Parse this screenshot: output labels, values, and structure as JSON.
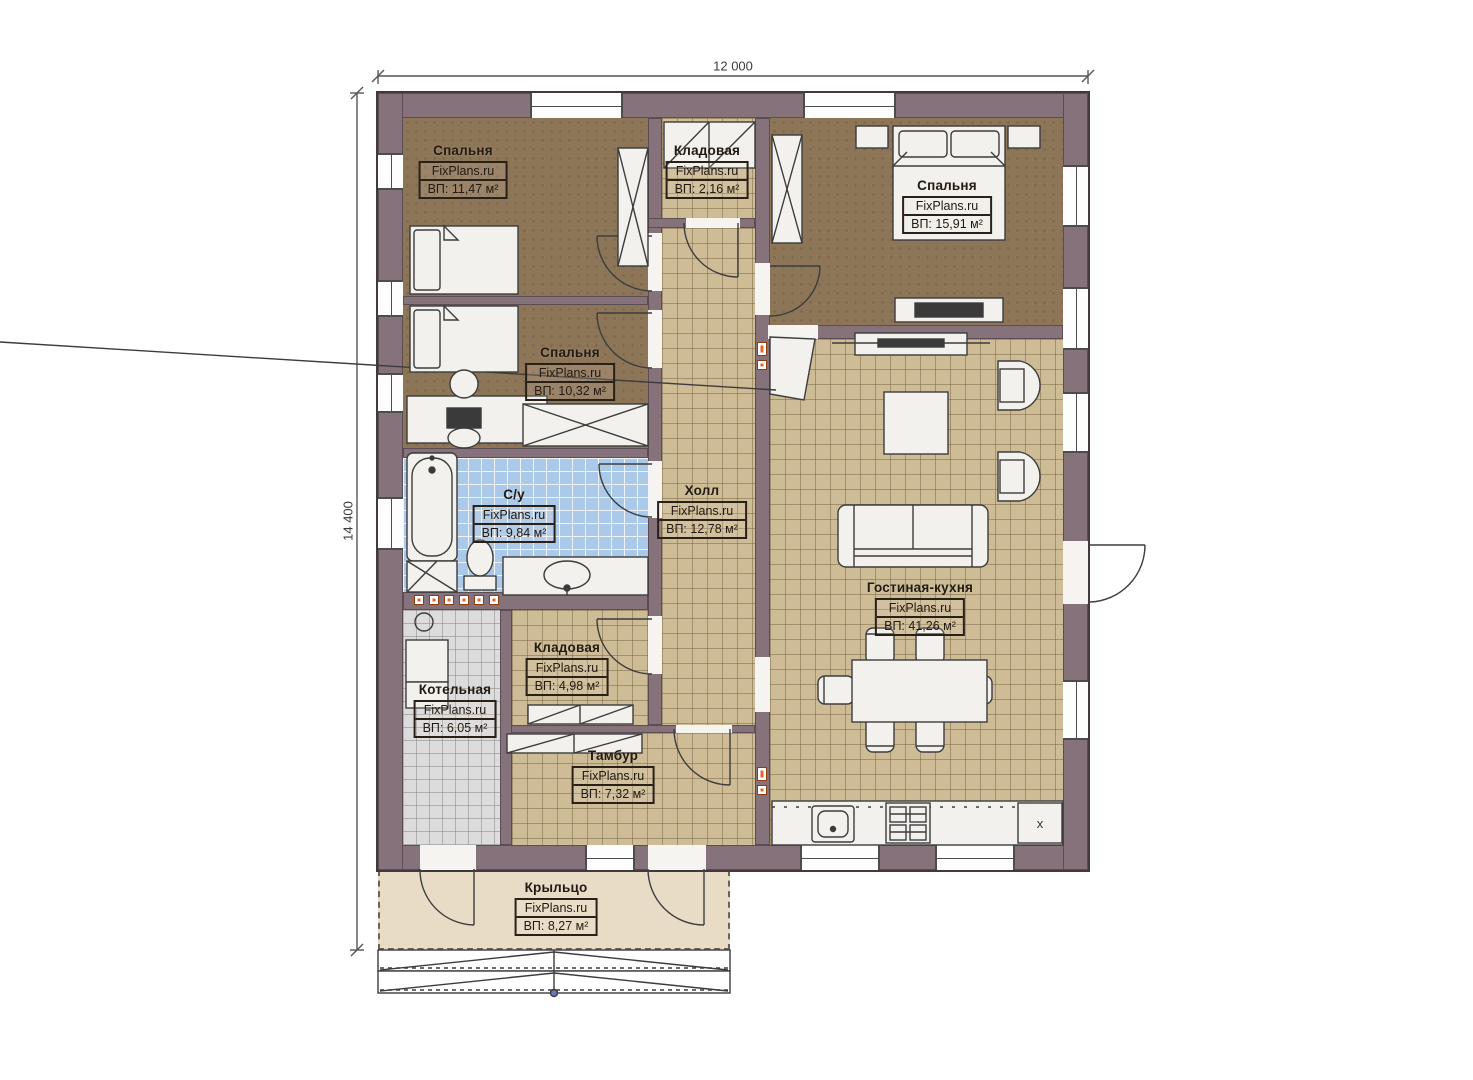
{
  "watermark": "FixPlans.ru",
  "dimensions": {
    "width": "12 000",
    "height": "14 400"
  },
  "rooms": [
    {
      "id": "bedroom-1",
      "name": "Спальня",
      "area": "ВП: 11,47 м²"
    },
    {
      "id": "pantry-top",
      "name": "Кладовая",
      "area": "ВП: 2,16 м²"
    },
    {
      "id": "bedroom-2",
      "name": "Спальня",
      "area": "ВП: 15,91 м²"
    },
    {
      "id": "bedroom-3",
      "name": "Спальня",
      "area": "ВП: 10,32 м²"
    },
    {
      "id": "bathroom",
      "name": "С/у",
      "area": "ВП: 9,84 м²"
    },
    {
      "id": "hall",
      "name": "Холл",
      "area": "ВП: 12,78 м²"
    },
    {
      "id": "living-kitchen",
      "name": "Гостиная-кухня",
      "area": "ВП: 41,26 м²"
    },
    {
      "id": "pantry-2",
      "name": "Кладовая",
      "area": "ВП: 4,98 м²"
    },
    {
      "id": "boiler-room",
      "name": "Котельная",
      "area": "ВП: 6,05 м²"
    },
    {
      "id": "vestibule",
      "name": "Тамбур",
      "area": "ВП: 7,32 м²"
    },
    {
      "id": "porch",
      "name": "Крыльцо",
      "area": "ВП: 8,27 м²"
    }
  ],
  "appliances": {
    "fridge_mark": "x"
  },
  "colors": {
    "wall": "#86727b",
    "bedroom_floor": "#8d7558",
    "tile_floor": "#cdbc96",
    "bath_floor": "#abc9e8",
    "boiler_floor": "#dcdcdc",
    "porch_floor": "#e8dcc6",
    "radiator": "#e2662c"
  }
}
